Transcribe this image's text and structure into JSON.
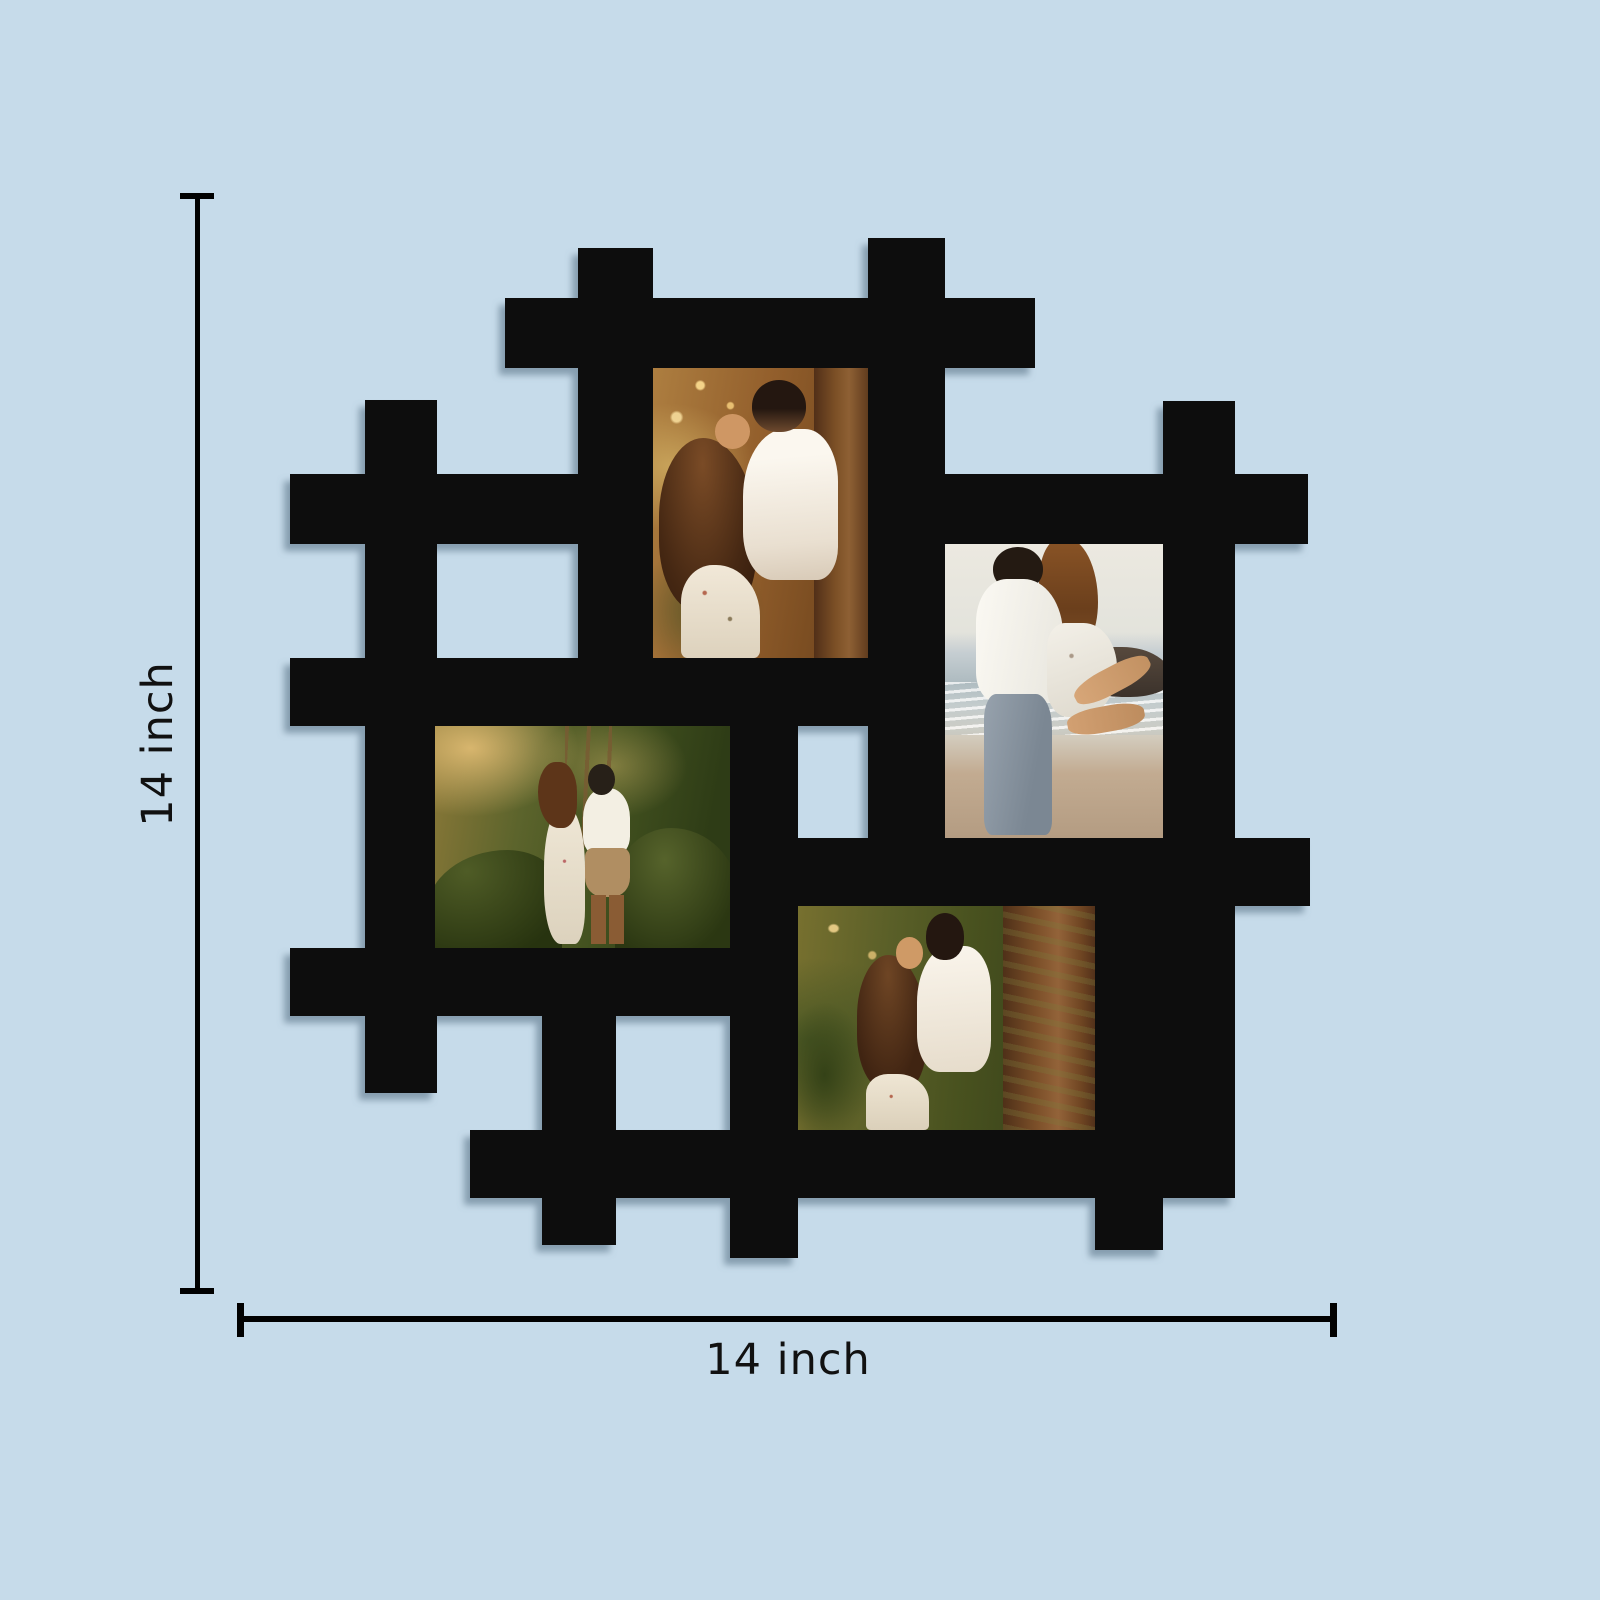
{
  "title": "Wall photo collage frame — product dimension illustration",
  "background_color": "#c6dbea",
  "frame": {
    "color": "#070707",
    "shadow_color": "#5a7488",
    "style": "hashtag woven lattice collage frame, black",
    "photo_count": 4
  },
  "dimensions": {
    "height_label": "14 inch",
    "width_label": "14 inch",
    "line_color": "#010101",
    "text_color": "#111111"
  },
  "photos": [
    {
      "id": "top-portrait",
      "orientation": "portrait",
      "description": "Couple embracing in golden forest light; man in white shirt kissing woman's forehead; woman with long auburn hair in white floral off-shoulder dress; tree trunk at right"
    },
    {
      "id": "right-portrait",
      "orientation": "portrait",
      "description": "Man in white shirt and gray jeans lifting and hugging woman in floral dress on a beach; sea horizon, white foam and dark rocks behind"
    },
    {
      "id": "left-landscape",
      "orientation": "landscape",
      "description": "Couple standing close among sunlit green foliage; woman in long white floral dress, man in white shirt and khaki shorts"
    },
    {
      "id": "bottom-landscape",
      "orientation": "landscape",
      "description": "Couple embracing beside a large mossy tree trunk in a golden forest"
    }
  ]
}
